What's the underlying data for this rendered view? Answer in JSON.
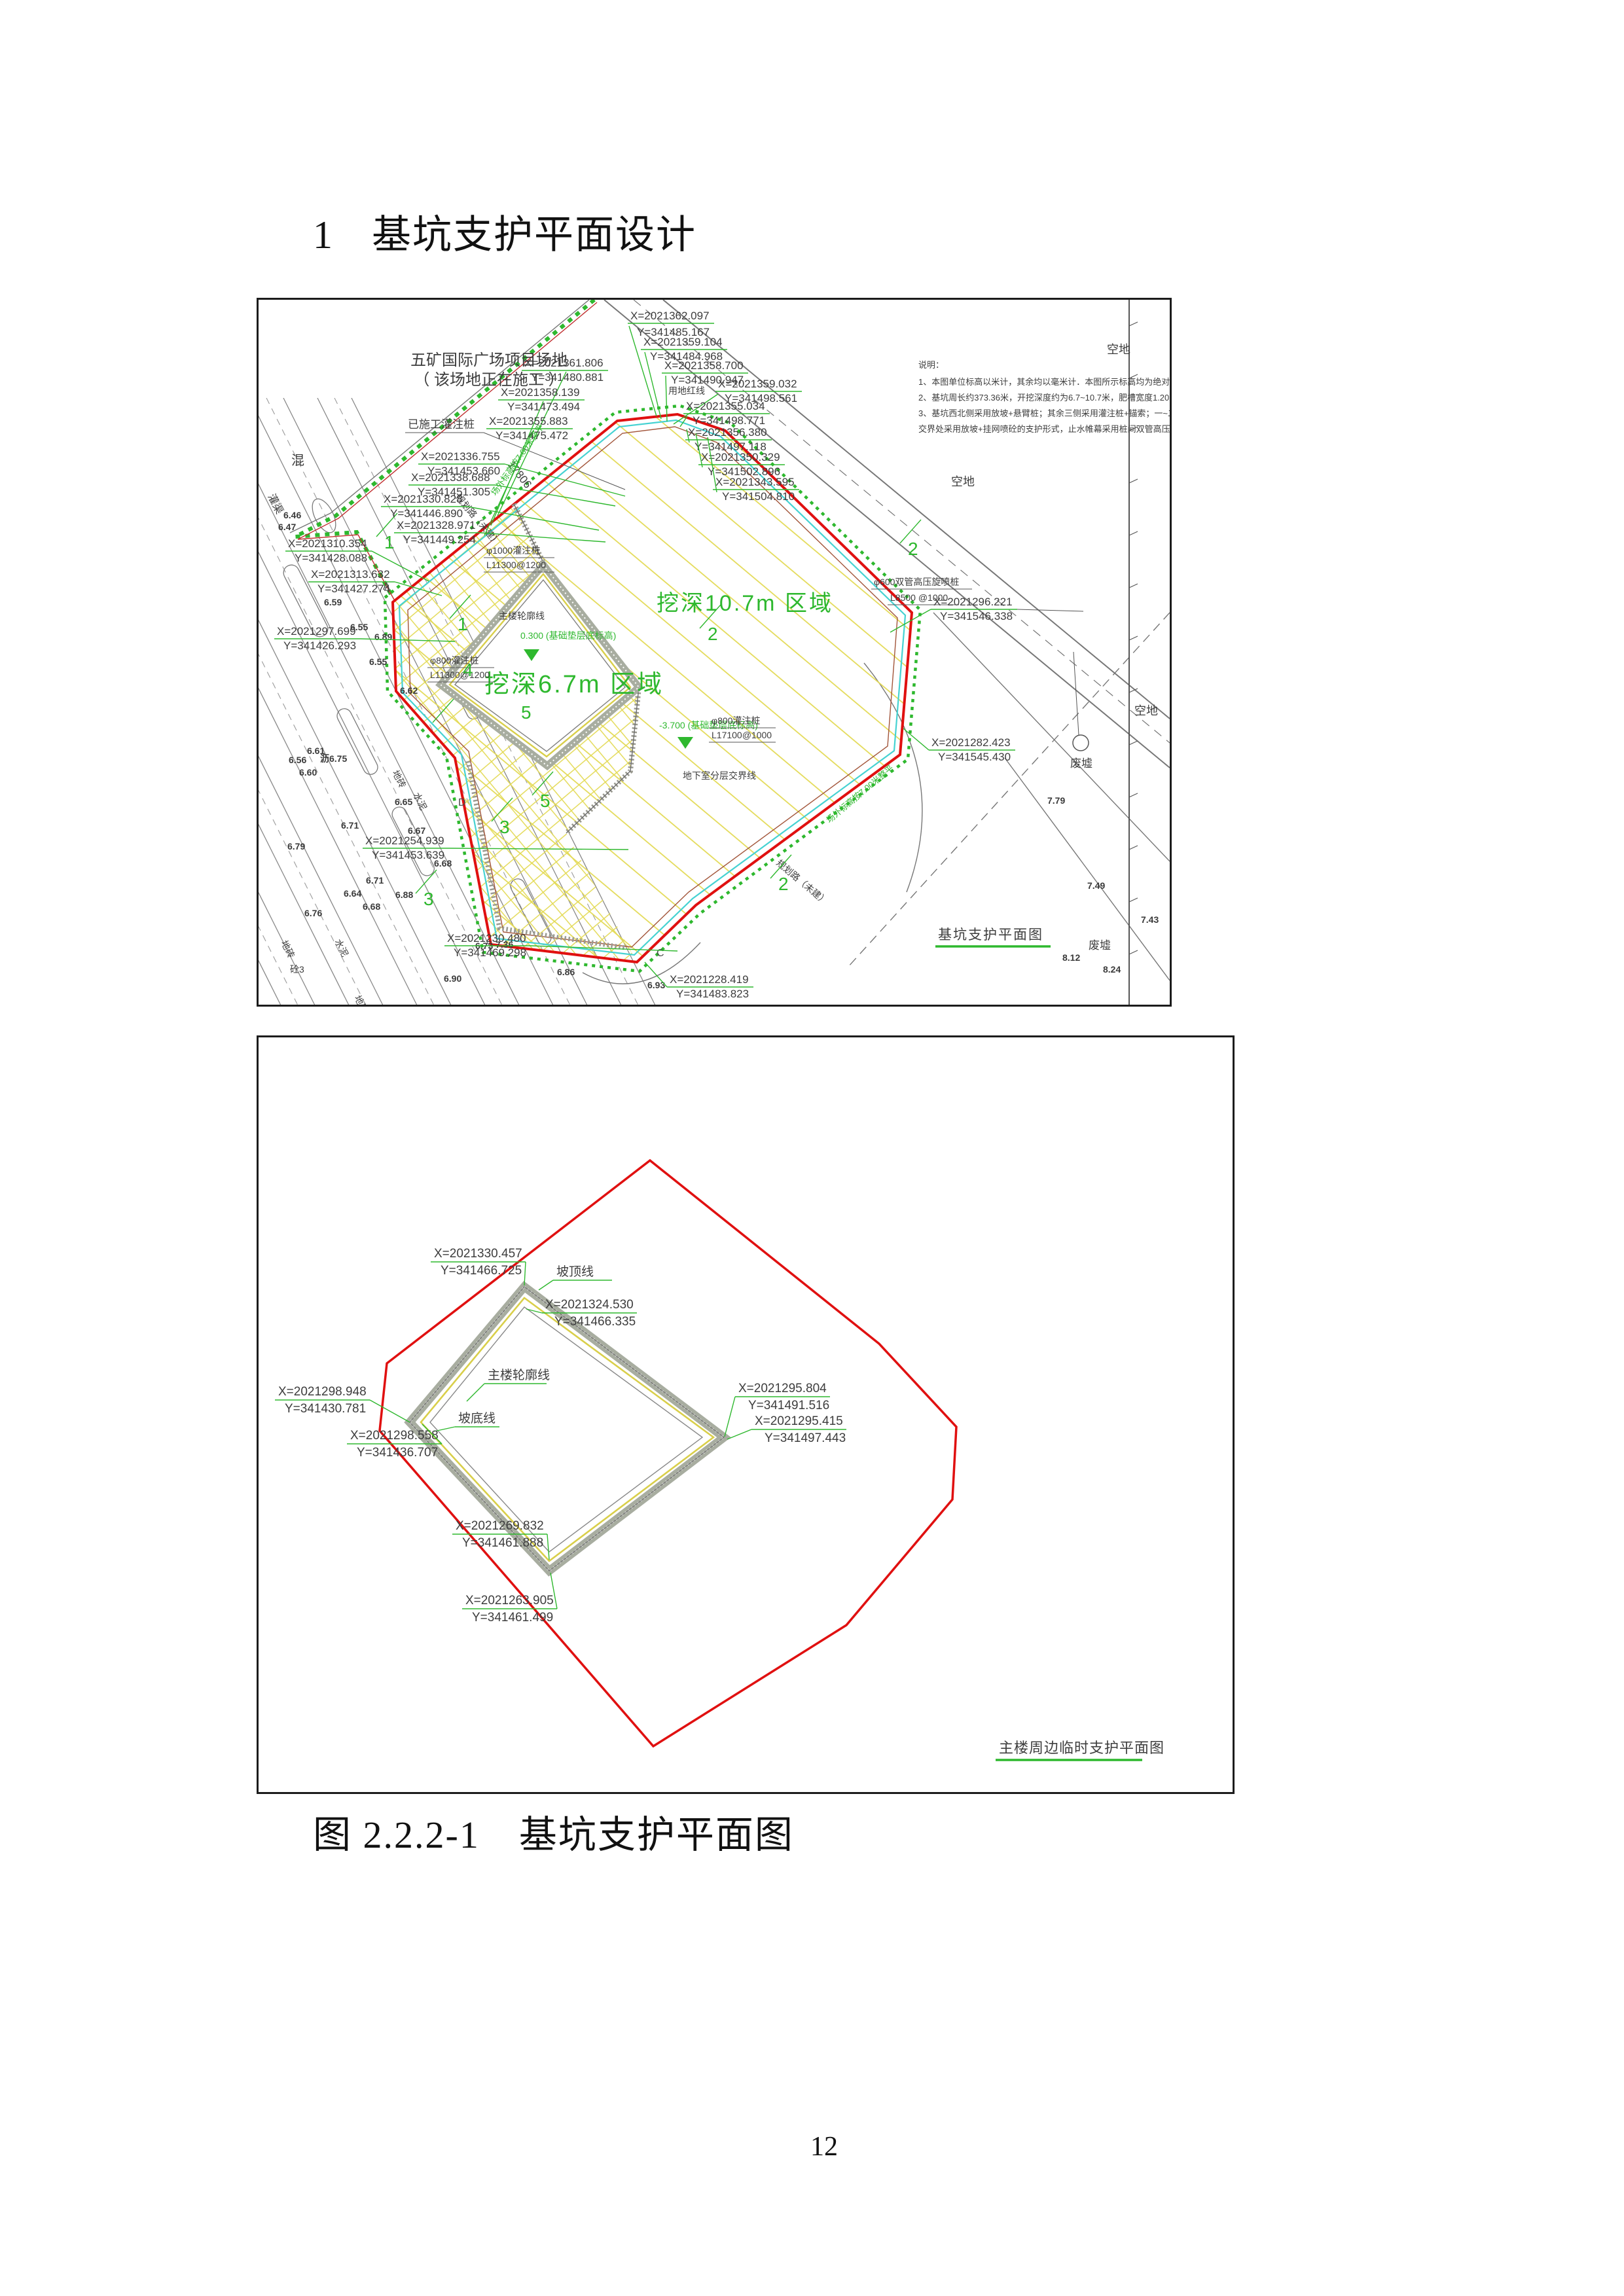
{
  "page": {
    "heading_number": "1",
    "heading_text": "基坑支护平面设计",
    "caption": "图 2.2.2-1　基坑支护平面图",
    "page_number": "12"
  },
  "colors": {
    "pit_outline": "#e01010",
    "annotation_green": "#2eb82e",
    "hatch_yellow": "#e3da55",
    "waterstop_cyan": "#45d2d2",
    "linework_gray": "#6e6e6e"
  },
  "drawing1": {
    "title": "基坑支护平面图",
    "site_label_line1": "五矿国际广场项目场地",
    "site_label_line2": "（ 该场地正在施工 ）",
    "constructed_pile_label": "已施工灌注桩",
    "red_line_label": "用地红线",
    "road_label": "规划路（未建）",
    "grade_label": "场外标高按7.00米整平",
    "boundary_label": "地下室分层交界线",
    "outline_label": "主楼轮廓线",
    "dim_17806": "17806",
    "region_deep": "挖深10.7m 区域",
    "region_shallow": "挖深6.7m 区域",
    "level_marker_1": "0.300 (基础垫层底标高)",
    "level_marker_2": "-3.700 (基础垫层底标高)",
    "empty_land": "空地",
    "ruins": "废墟",
    "canal": "灌渠",
    "concrete": "混",
    "notes": [
      "说明：",
      "1、本图单位标高以米计，其余均以毫米计．本图所示标高均为绝对标高．",
      "2、基坑周长约373.36米，开挖深度约为6.7~10.7米，肥槽宽度1.20米．",
      "3、基坑西北侧采用放坡+悬臂桩；其余三侧采用灌注桩+锚索；一~二层地下室",
      "交界处采用放坡+挂网喷砼的支护形式，止水帷幕采用桩间双管高压旋喷桩．"
    ],
    "pile1": [
      "φ1000灌注桩",
      "L11300@1200"
    ],
    "pile2": [
      "φ800灌注桩",
      "L11300@1200"
    ],
    "pile3": [
      "φ800灌注桩",
      "L17100@1000"
    ],
    "pile4": [
      "φ600双管高压旋喷桩",
      "L8500 @1000"
    ],
    "street_labels": [
      "地砖",
      "水泥",
      "地砖",
      "水泥",
      "砼3",
      "地砖"
    ],
    "coords": [
      {
        "x": "X=2021362.097",
        "y": "Y=341485.167"
      },
      {
        "x": "X=2021359.104",
        "y": "Y=341484.968"
      },
      {
        "x": "X=2021358.700",
        "y": "Y=341490.947"
      },
      {
        "x": "X=2021359.032",
        "y": "Y=341498.561"
      },
      {
        "x": "X=2021355.034",
        "y": "Y=341498.771"
      },
      {
        "x": "X=2021356.380",
        "y": "Y=341497.118"
      },
      {
        "x": "X=2021350.329",
        "y": "Y=341502.896"
      },
      {
        "x": "X=2021343.595",
        "y": "Y=341504.810"
      },
      {
        "x": "X=2021361.806",
        "y": "Y=341480.881"
      },
      {
        "x": "X=2021358.139",
        "y": "Y=341473.494"
      },
      {
        "x": "X=2021355.883",
        "y": "Y=341475.472"
      },
      {
        "x": "X=2021336.755",
        "y": "Y=341453.660"
      },
      {
        "x": "X=2021338.688",
        "y": "Y=341451.305"
      },
      {
        "x": "X=2021330.828",
        "y": "Y=341446.890"
      },
      {
        "x": "X=2021328.971",
        "y": "Y=341449.254"
      },
      {
        "x": "X=2021310.354",
        "y": "Y=341428.088"
      },
      {
        "x": "X=2021313.632",
        "y": "Y=341427.274"
      },
      {
        "x": "X=2021297.699",
        "y": "Y=341426.293"
      },
      {
        "x": "X=2021254.939",
        "y": "Y=341453.639"
      },
      {
        "x": "X=2021230.480",
        "y": "Y=341469.298"
      },
      {
        "x": "X=2021228.419",
        "y": "Y=341483.823"
      },
      {
        "x": "X=2021296.221",
        "y": "Y=341546.338"
      },
      {
        "x": "X=2021282.423",
        "y": "Y=341545.430"
      }
    ],
    "spots": [
      "7.79",
      "7.49",
      "7.43",
      "8.12",
      "8.24",
      "6.93",
      "7.36",
      "6.86",
      "6.90",
      "6.71",
      "6.79",
      "6.65",
      "6.67",
      "6.68",
      "6.56",
      "6.61",
      "6.60",
      "6.59",
      "6.64",
      "6.55",
      "6.89",
      "6.62",
      "6.47",
      "6.46",
      "6.76",
      "6.73",
      "6.88",
      "6.71",
      "6.68",
      "6.55",
      "沥6.75"
    ],
    "sections": [
      "1",
      "1",
      "2",
      "2",
      "2",
      "3",
      "3",
      "4",
      "5",
      "5"
    ],
    "letters": [
      "A",
      "C",
      "D"
    ]
  },
  "drawing2": {
    "title": "主楼周边临时支护平面图",
    "slope_top_label": "坡顶线",
    "slope_bottom_label": "坡底线",
    "outline_label": "主楼轮廓线",
    "coords": [
      {
        "x": "X=2021330.457",
        "y": "Y=341466.725"
      },
      {
        "x": "X=2021324.530",
        "y": "Y=341466.335"
      },
      {
        "x": "X=2021298.948",
        "y": "Y=341430.781"
      },
      {
        "x": "X=2021298.558",
        "y": "Y=341436.707"
      },
      {
        "x": "X=2021295.804",
        "y": "Y=341491.516"
      },
      {
        "x": "X=2021295.415",
        "y": "Y=341497.443"
      },
      {
        "x": "X=2021269.832",
        "y": "Y=341461.888"
      },
      {
        "x": "X=2021263.905",
        "y": "Y=341461.499"
      }
    ]
  }
}
